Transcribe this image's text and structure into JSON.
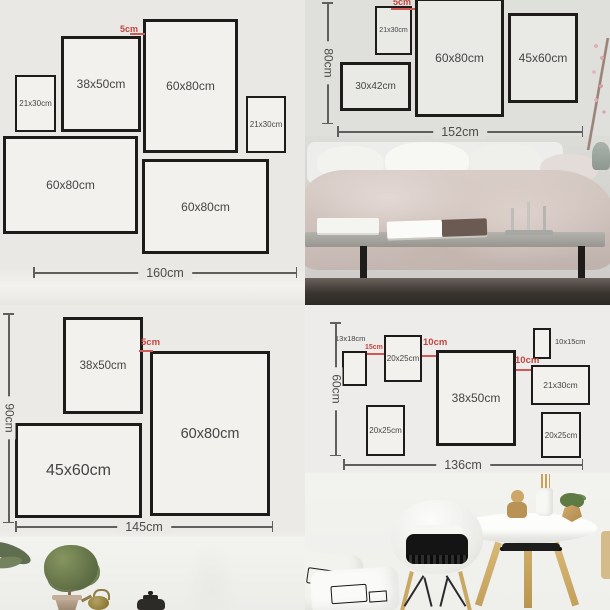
{
  "colors": {
    "accent_red": "#c6443f",
    "frame_border": "#1d1c1a"
  },
  "q1": {
    "frames": [
      {
        "label": "21x30cm"
      },
      {
        "label": "38x50cm"
      },
      {
        "label": "60x80cm"
      },
      {
        "label": "21x30cm"
      },
      {
        "label": "60x80cm"
      },
      {
        "label": "60x80cm"
      }
    ],
    "gap_label": "5cm",
    "width_label": "160cm"
  },
  "q2": {
    "frames": [
      {
        "label": "21x30cm"
      },
      {
        "label": "30x42cm"
      },
      {
        "label": "60x80cm"
      },
      {
        "label": "45x60cm"
      }
    ],
    "gap_label": "5cm",
    "height_label": "80cm",
    "width_label": "152cm"
  },
  "q3": {
    "frames": [
      {
        "label": "38x50cm"
      },
      {
        "label": "60x80cm"
      },
      {
        "label": "45x60cm"
      }
    ],
    "gap_label": "5cm",
    "height_label": "90cm",
    "width_label": "145cm"
  },
  "q4": {
    "frames": [
      {
        "label": "13x18cm"
      },
      {
        "label": "20x25cm"
      },
      {
        "label": "38x50cm"
      },
      {
        "label": "10x15cm"
      },
      {
        "label": "21x30cm"
      },
      {
        "label": "20x25cm"
      },
      {
        "label": "20x25cm"
      }
    ],
    "gaps": [
      "15cm",
      "10cm",
      "10cm"
    ],
    "height_label": "60cm",
    "width_label": "136cm"
  }
}
